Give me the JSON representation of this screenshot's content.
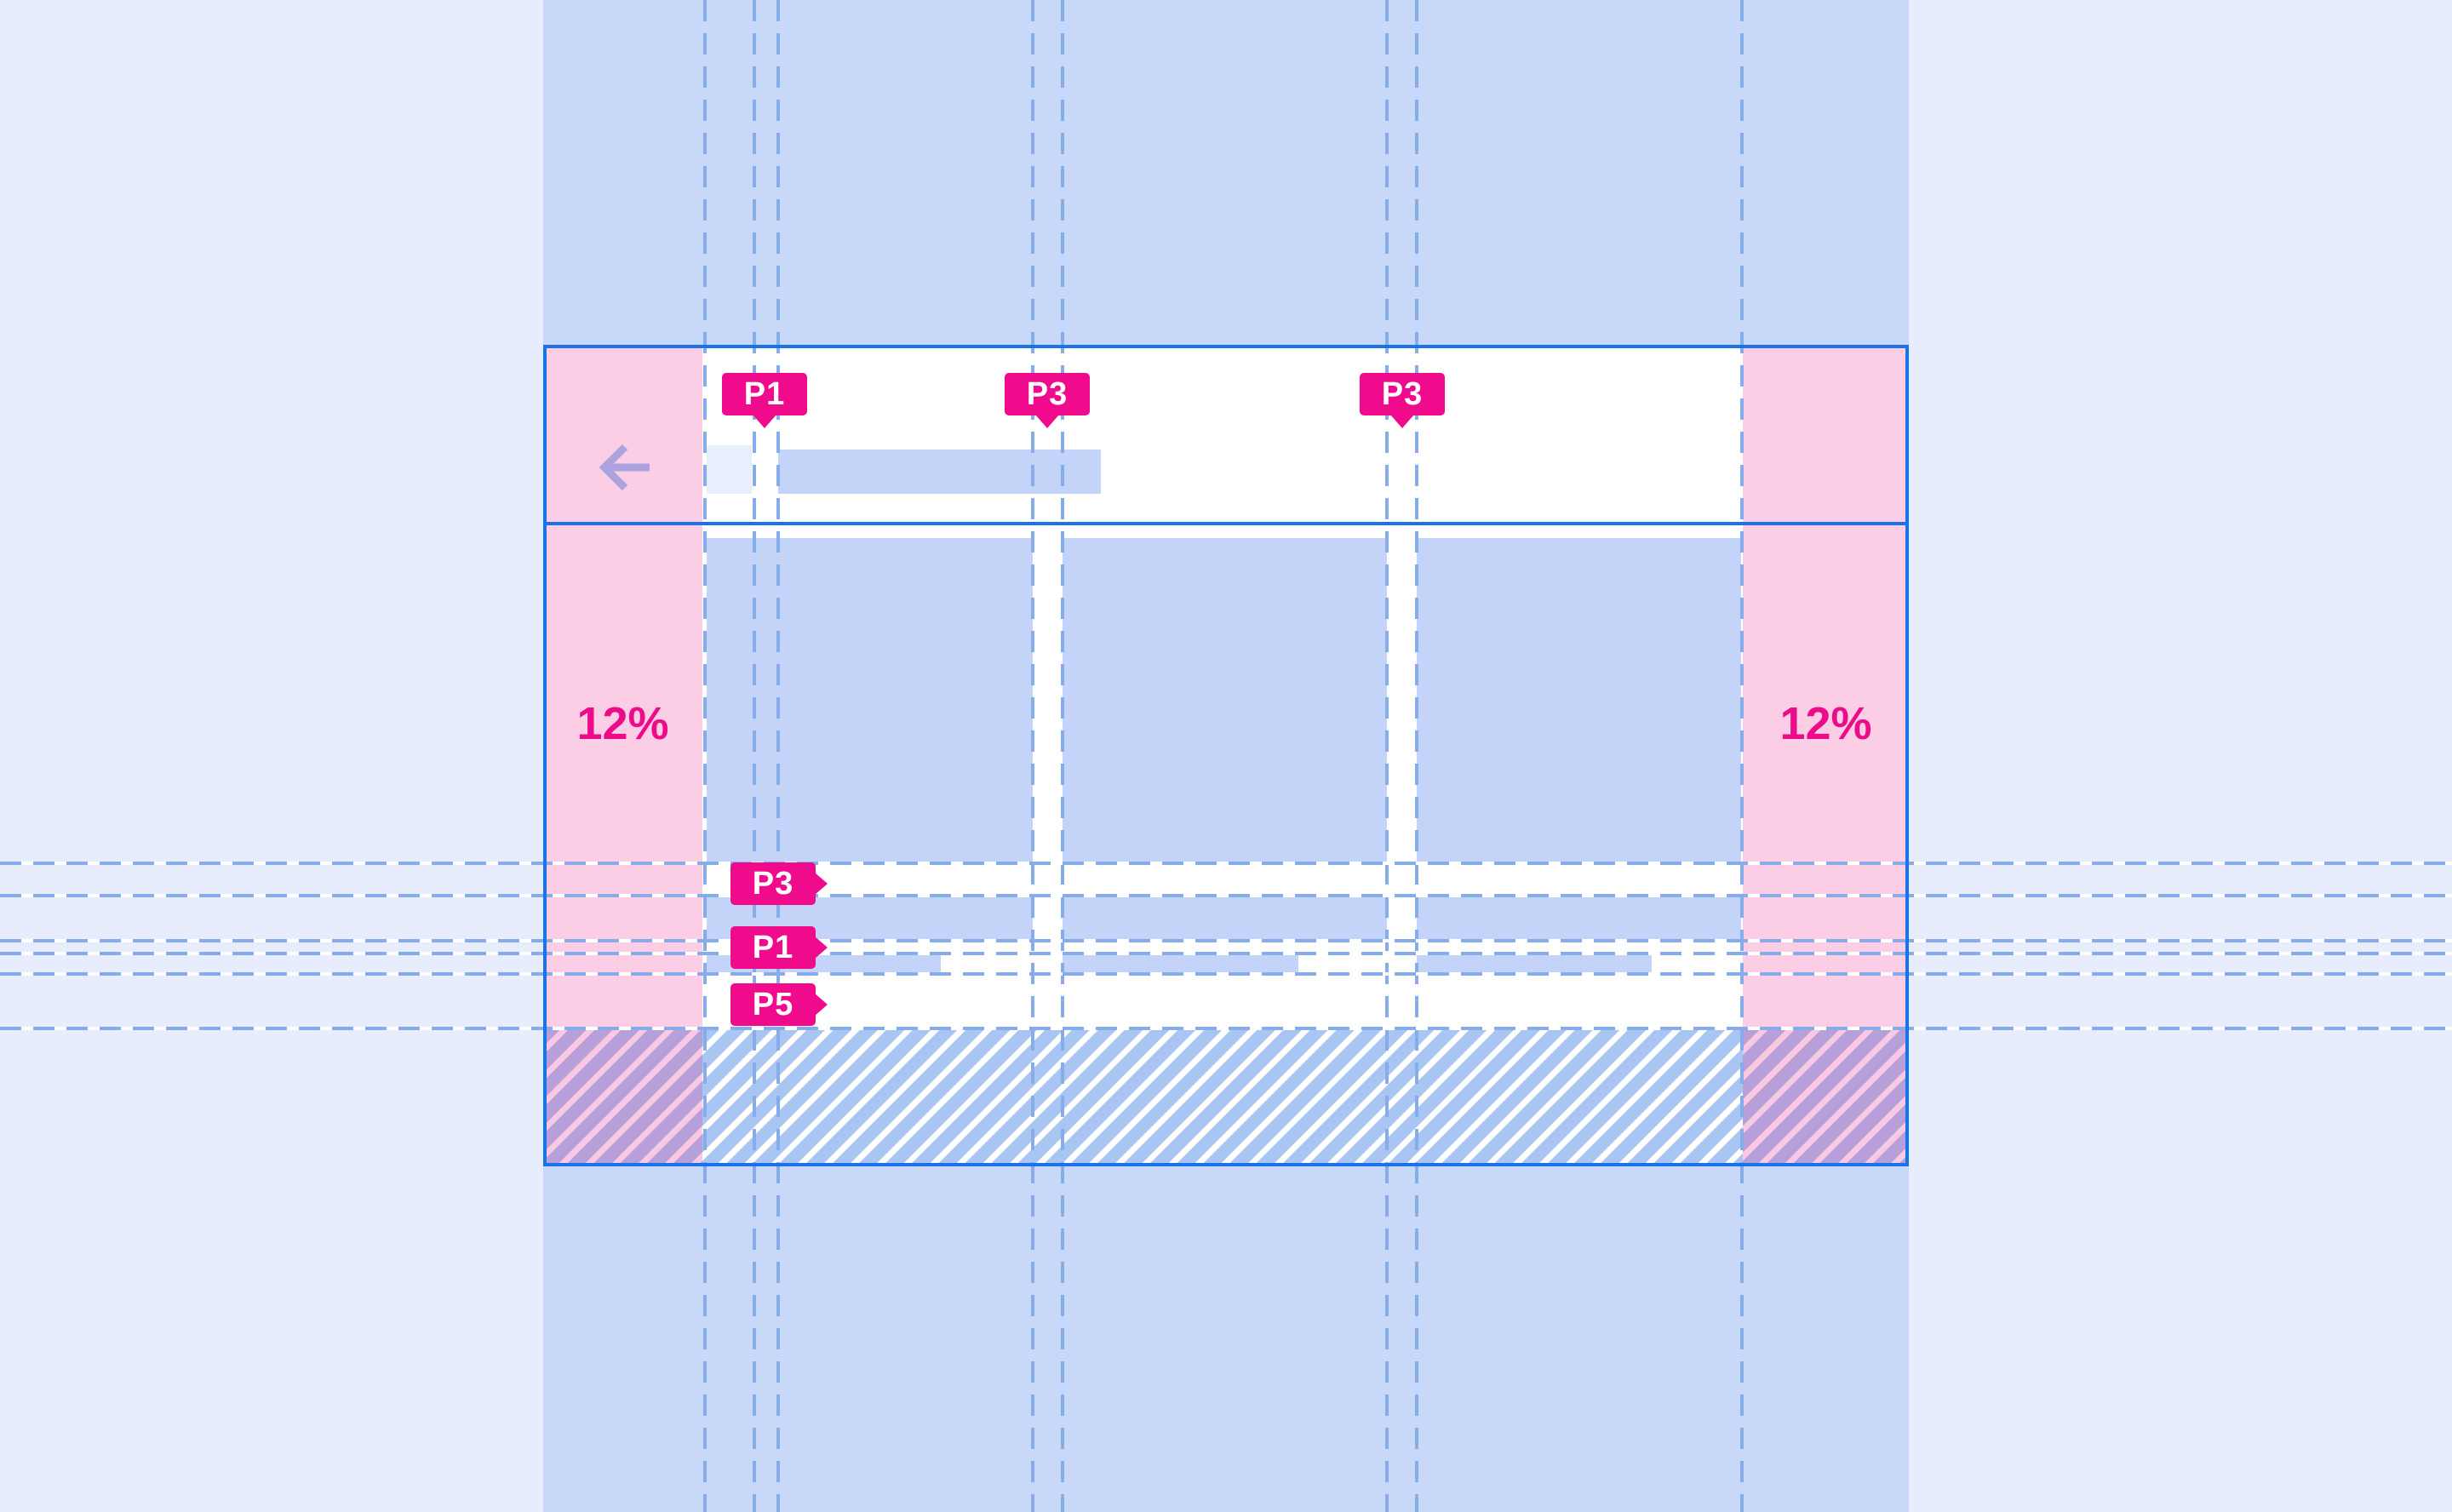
{
  "annotations": {
    "top": [
      {
        "text": "P1"
      },
      {
        "text": "P3"
      },
      {
        "text": "P3"
      }
    ],
    "side": [
      {
        "text": "P3"
      },
      {
        "text": "P1"
      },
      {
        "text": "P5"
      }
    ],
    "left_margin_pct": "12%",
    "right_margin_pct": "12%"
  },
  "icons": {
    "back": "arrow-back-icon"
  },
  "colors": {
    "background": "#e7edfc",
    "column_band": "#c7d8f9",
    "frame_outline": "#1a73e8",
    "margin_pink": "#fbcee6",
    "placeholder_blue": "#c3d4f8",
    "icon_box": "#e9eefc",
    "guide_dash": "#86ade9",
    "annotation_magenta": "#f00a8c",
    "back_arrow": "#aba3dd",
    "hatch_over_pink": "#b7a0da",
    "hatch_over_white": "#a9c5f2"
  }
}
